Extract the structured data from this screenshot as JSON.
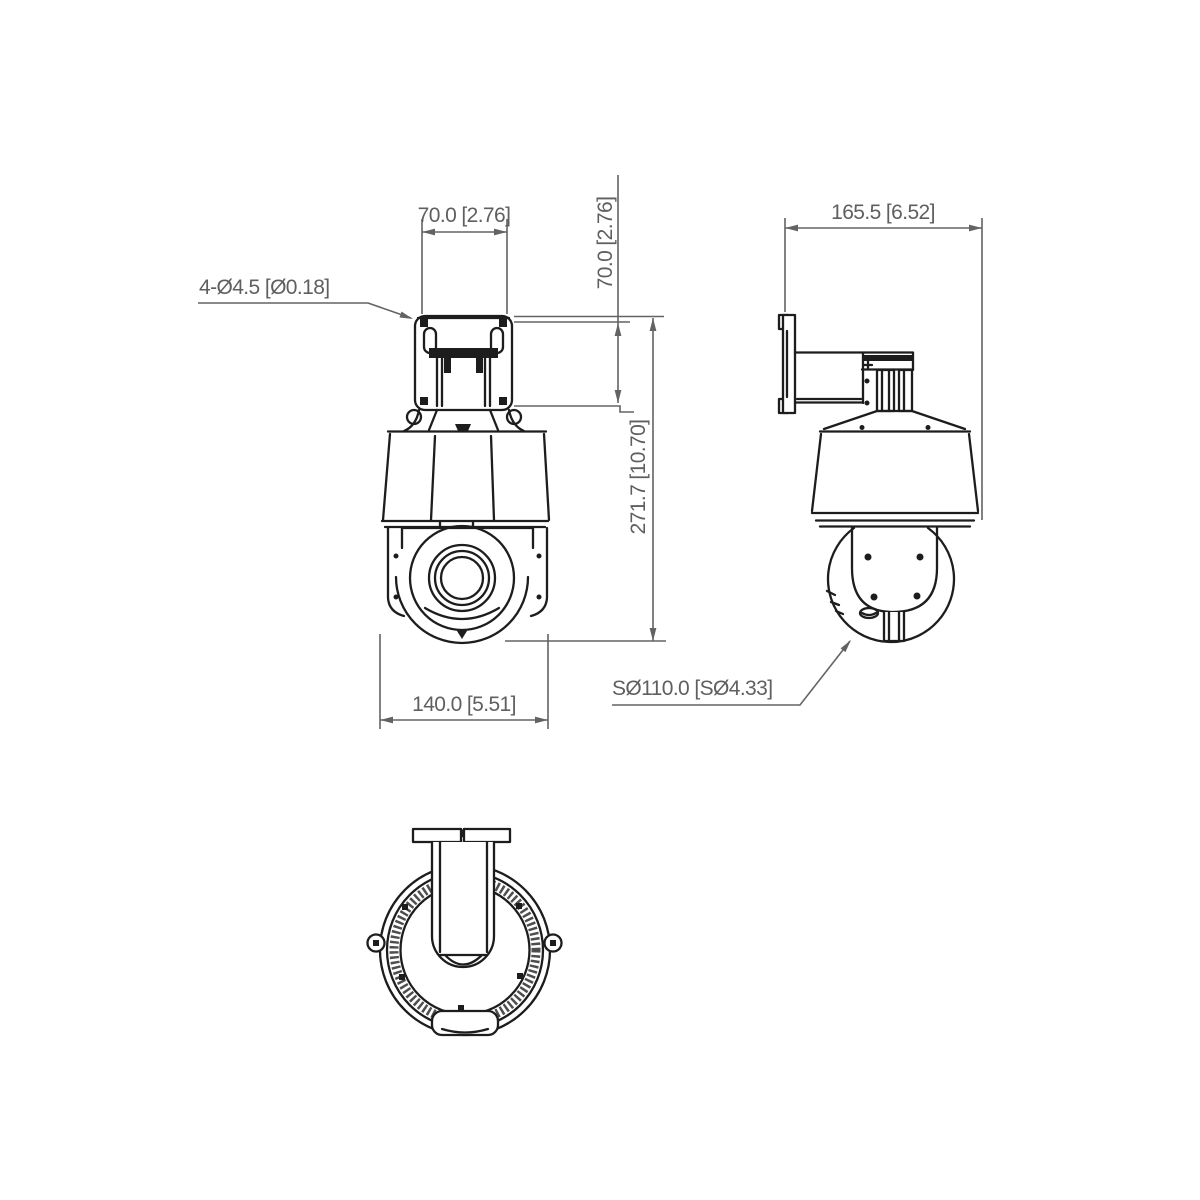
{
  "drawing": {
    "labels": {
      "holes": "4-Ø4.5 [Ø0.18]",
      "top_width": "70.0 [2.76]",
      "side_offset": "70.0 [2.76]",
      "total_height": "271.7 [10.70]",
      "body_width": "140.0 [5.51]",
      "depth": "165.5 [6.52]",
      "sphere_diameter": "SØ110.0 [SØ4.33]"
    },
    "colors": {
      "line": "#1d1d1d",
      "dimension": "#636363",
      "background": "#ffffff"
    }
  }
}
